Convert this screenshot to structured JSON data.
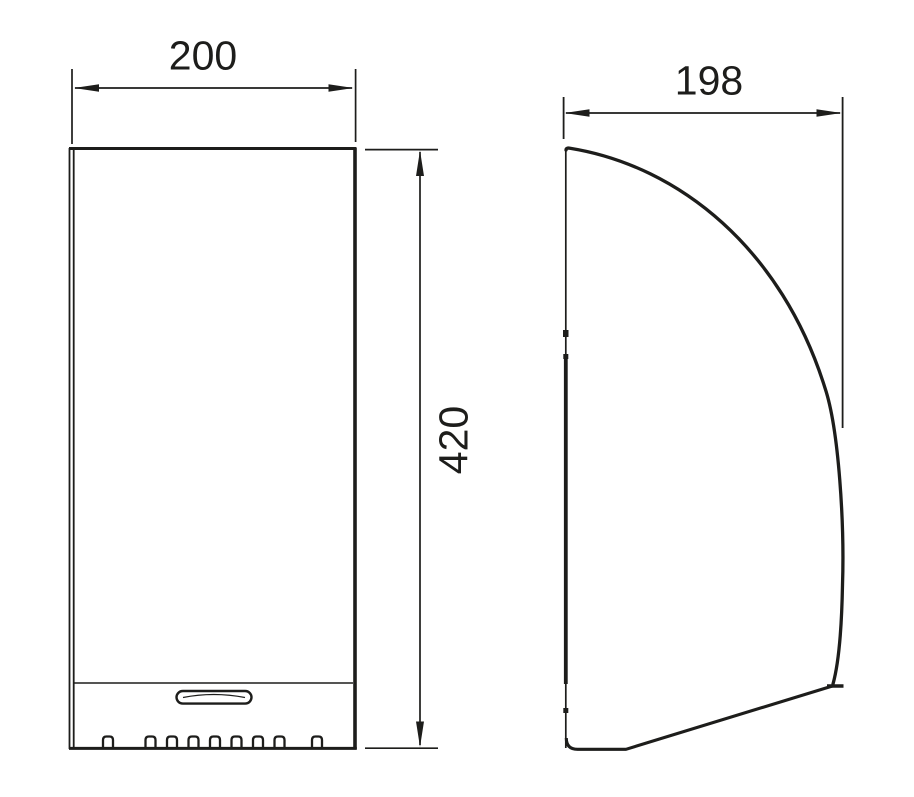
{
  "colors": {
    "background": "#ffffff",
    "line": "#1d1d1b"
  },
  "dimensions": {
    "width": {
      "value": "200",
      "orientation": "horizontal",
      "applies_to": "front-view"
    },
    "height": {
      "value": "420",
      "orientation": "vertical",
      "applies_to": "front-view"
    },
    "depth": {
      "value": "198",
      "orientation": "horizontal",
      "applies_to": "side-view"
    }
  }
}
